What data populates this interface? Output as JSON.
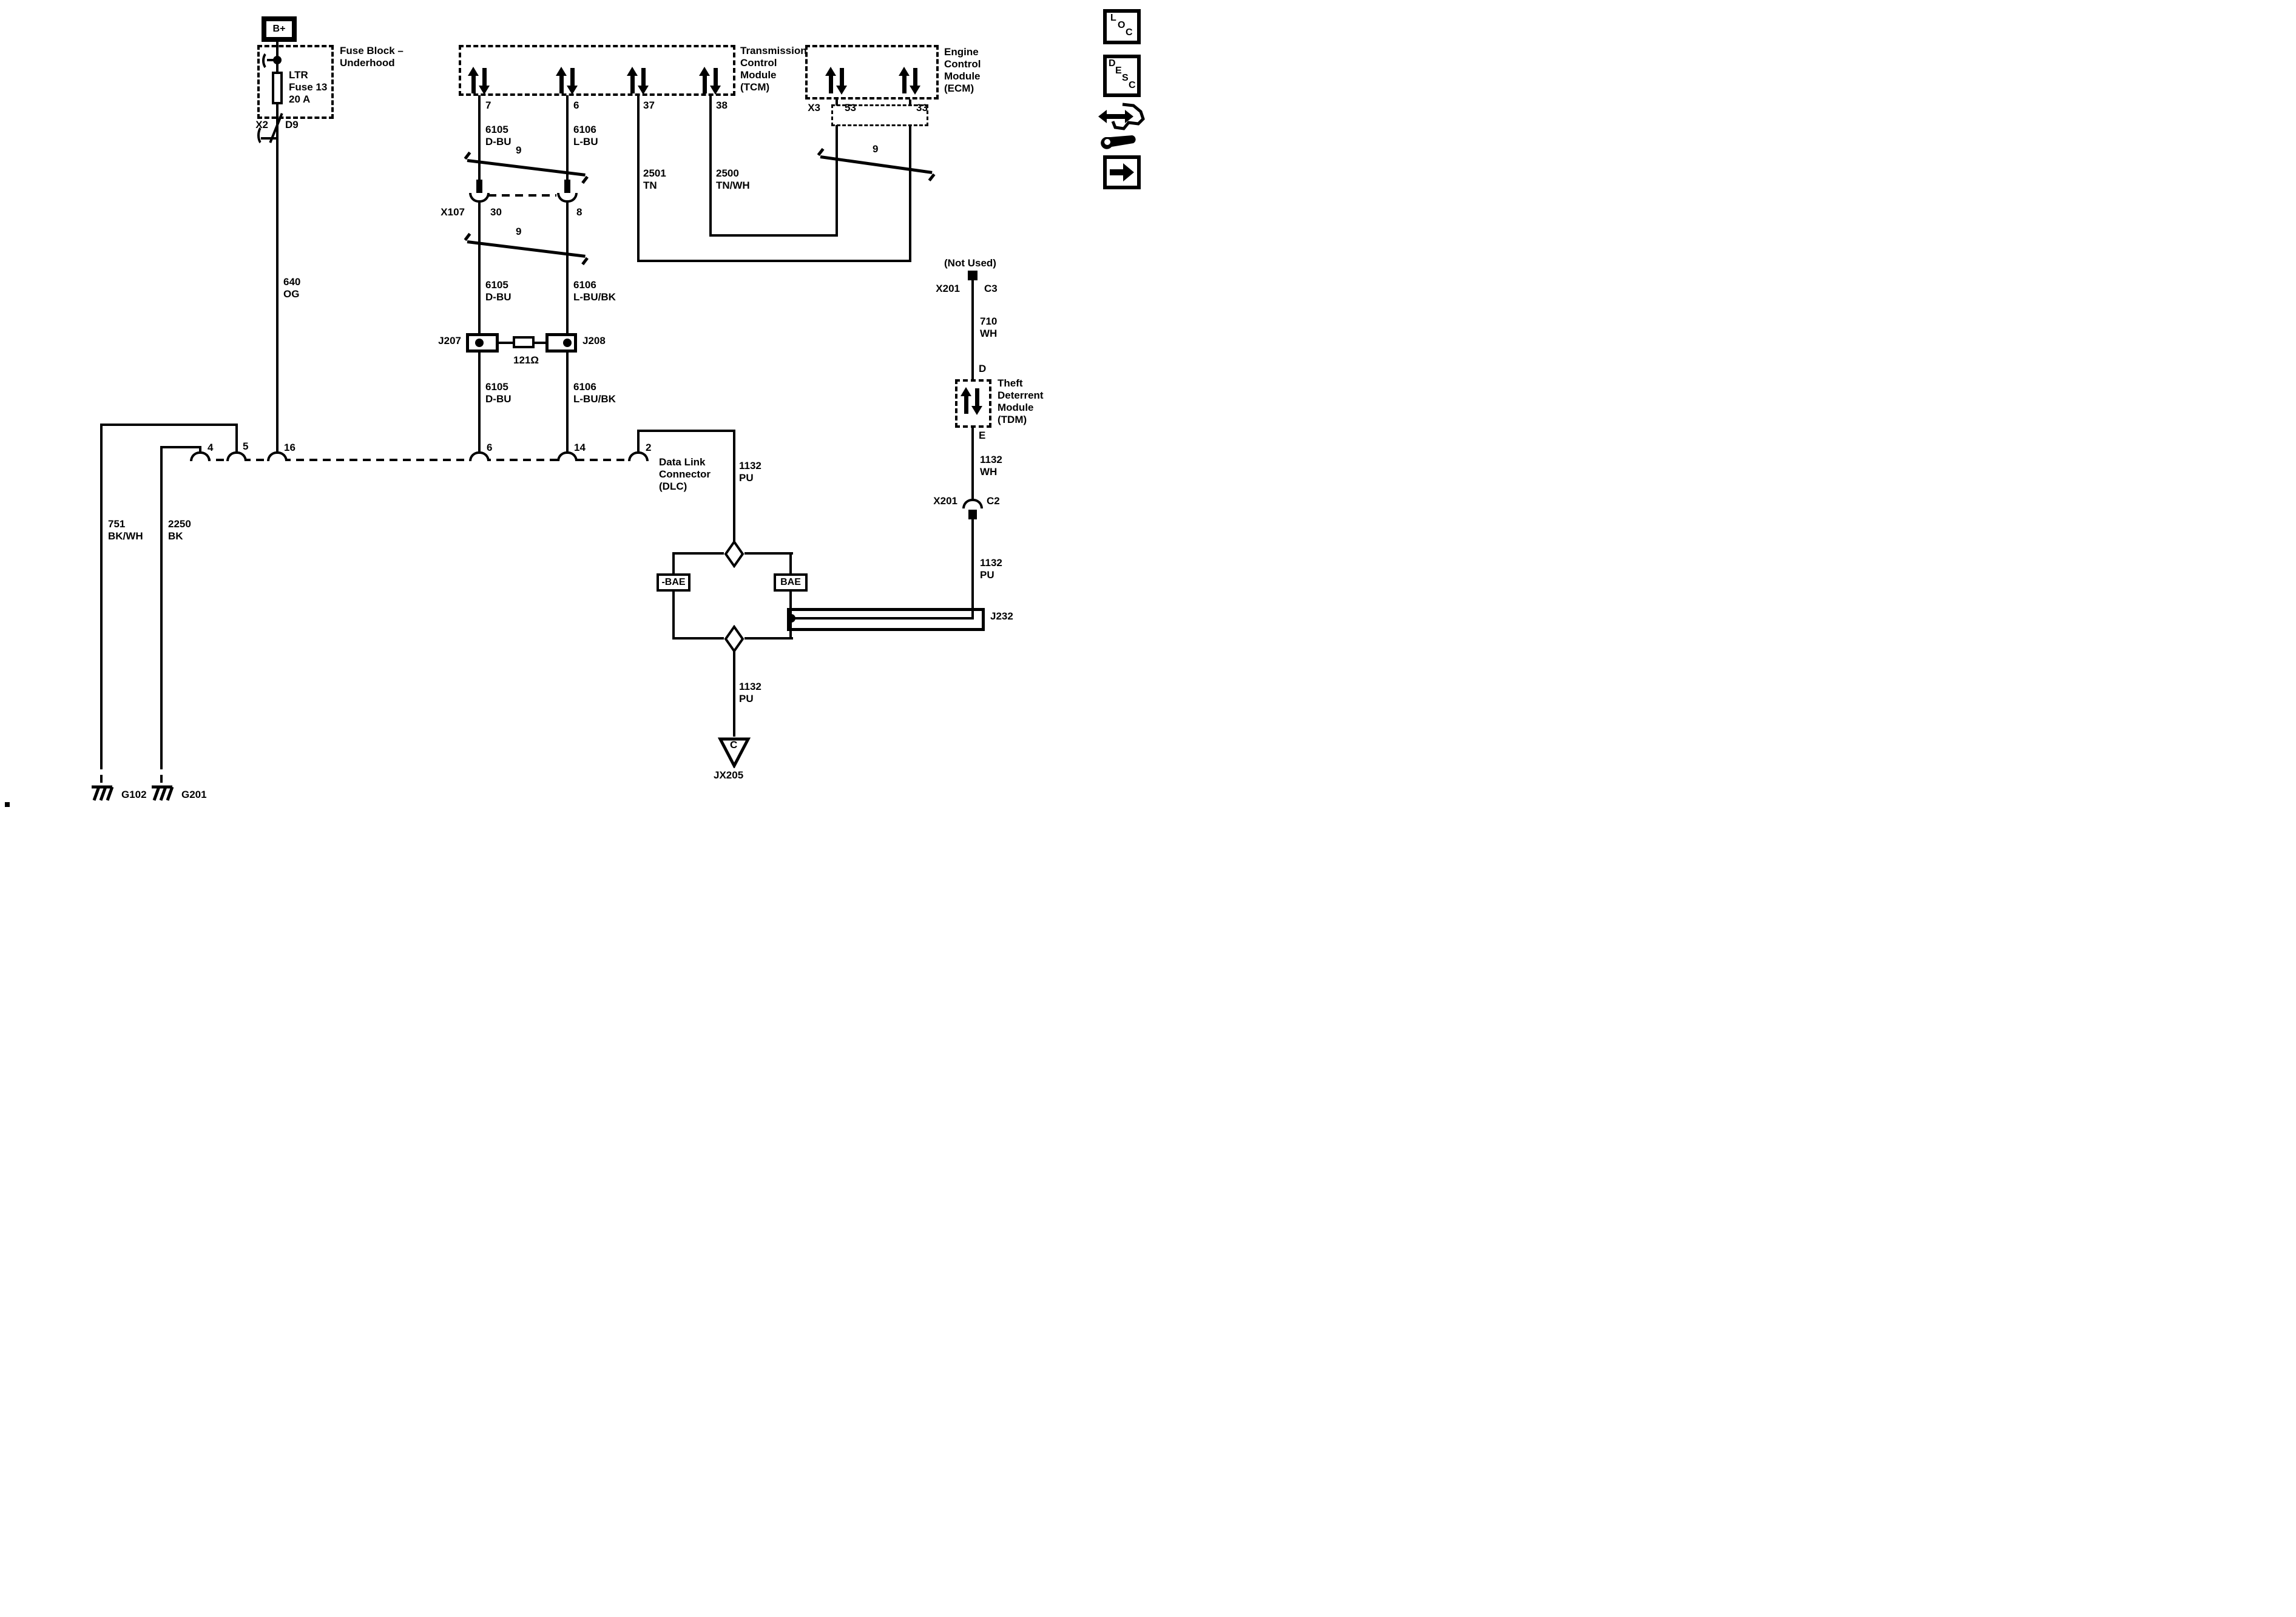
{
  "colors": {
    "ink": "#000000",
    "paper": "#ffffff"
  },
  "power": {
    "b_plus": "B+"
  },
  "fuse_block": {
    "title": "Fuse Block –\nUnderhood",
    "fuse": "LTR\nFuse 13\n20 A",
    "conn": "X2",
    "pin": "D9"
  },
  "wires": {
    "w640": "640\nOG",
    "w751": "751\nBK/WH",
    "w2250": "2250\nBK",
    "w6105_1": "6105\nD-BU",
    "w6106_1": "6106\nL-BU",
    "w6105_2": "6105\nD-BU",
    "w6106_2": "6106\nL-BU/BK",
    "w6105_3": "6105\nD-BU",
    "w6106_3": "6106\nL-BU/BK",
    "w2501": "2501\nTN",
    "w2500": "2500\nTN/WH",
    "w710": "710\nWH",
    "w1132_wh": "1132\nWH",
    "w1132_pu_dlc": "1132\nPU",
    "w1132_pu_right": "1132\nPU",
    "w1132_pu_bottom": "1132\nPU"
  },
  "twisted_pairs": {
    "t1": "9",
    "t2": "9",
    "t3": "9"
  },
  "tcm": {
    "title": "Transmission\nControl\nModule\n(TCM)",
    "pin7": "7",
    "pin6": "6",
    "pin37": "37",
    "pin38": "38"
  },
  "ecm": {
    "title": "Engine\nControl\nModule\n(ECM)",
    "conn": "X3",
    "pin53": "53",
    "pin33": "33"
  },
  "tdm": {
    "title": "Theft\nDeterrent\nModule\n(TDM)",
    "not_used": "(Not Used)",
    "pin_d": "D",
    "pin_e": "E",
    "c3_conn": "X201",
    "c3_pin": "C3",
    "c2_conn": "X201",
    "c2_pin": "C2"
  },
  "x107": {
    "name": "X107",
    "pin30": "30",
    "pin8": "8"
  },
  "dlc": {
    "title": "Data Link\nConnector\n(DLC)",
    "pin4": "4",
    "pin5": "5",
    "pin16": "16",
    "pin6": "6",
    "pin14": "14",
    "pin2": "2"
  },
  "splices": {
    "j207": "J207",
    "j208": "J208",
    "resistor": "121Ω",
    "j232": "J232",
    "jx205": "JX205",
    "jx205_pin": "C"
  },
  "bae": {
    "neg": "-BAE",
    "pos": "BAE"
  },
  "grounds": {
    "g102": "G102",
    "g201": "G201"
  },
  "legend": {
    "loc": [
      "L",
      "O",
      "C"
    ],
    "desc": [
      "D",
      "E",
      "S",
      "C"
    ]
  }
}
